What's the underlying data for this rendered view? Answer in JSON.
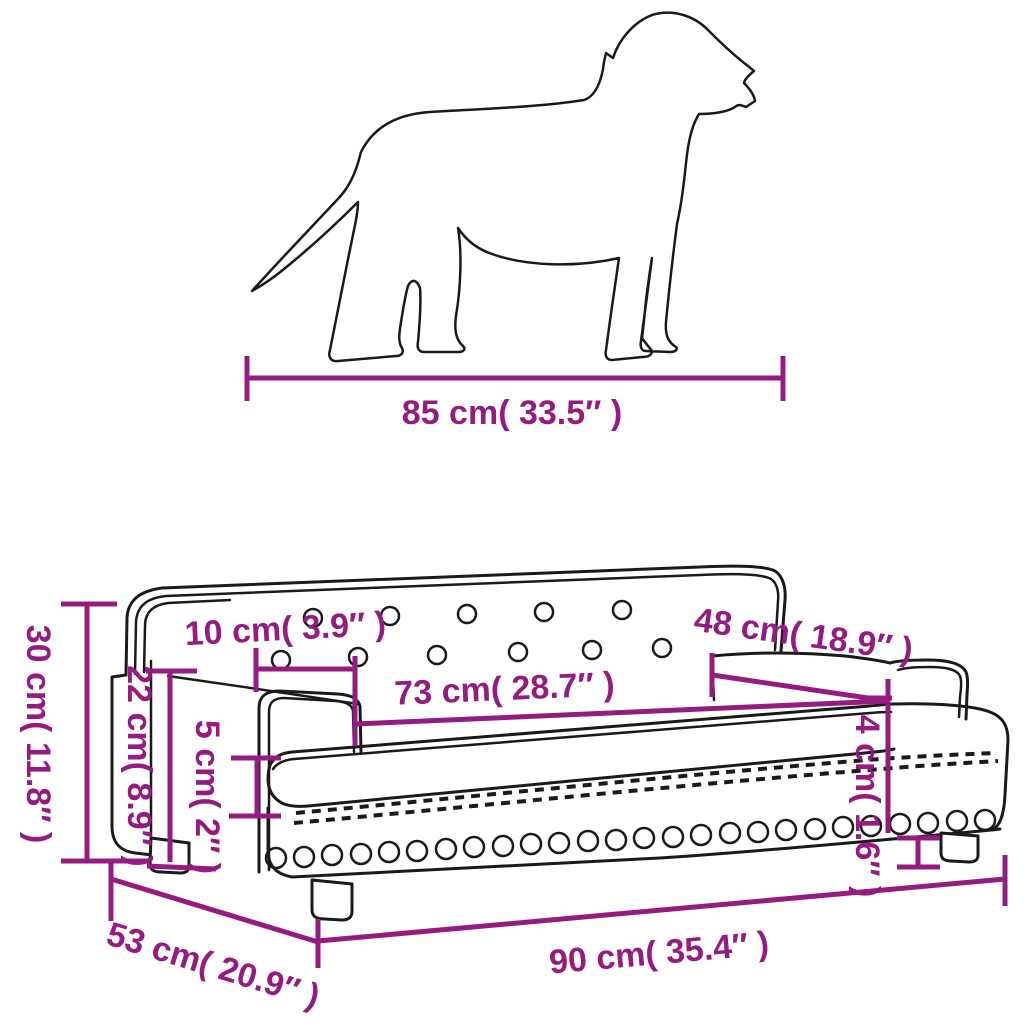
{
  "diagram": {
    "type": "product-dimension-diagram",
    "product": "dog sofa pet bed with measuring dog silhouette",
    "accent_color": "#951B81",
    "outline_color": "#1A1A1A",
    "background_color": "#FFFFFF",
    "dog": {
      "length_label": "85 cm( 33.5″ )"
    },
    "sofa": {
      "overall_height": "30 cm( 11.8″ )",
      "wall_thickness": "10 cm( 3.9″ )",
      "backrest_height": "22 cm( 8.9″ )",
      "cushion_height": "5 cm( 2″ )",
      "inner_length": "73 cm( 28.7″ )",
      "inner_depth": "48 cm( 18.9″ )",
      "leg_height": "4 cm( 1.6″ )",
      "overall_depth": "53 cm( 20.9″ )",
      "overall_length": "90 cm( 35.4″ )"
    }
  }
}
